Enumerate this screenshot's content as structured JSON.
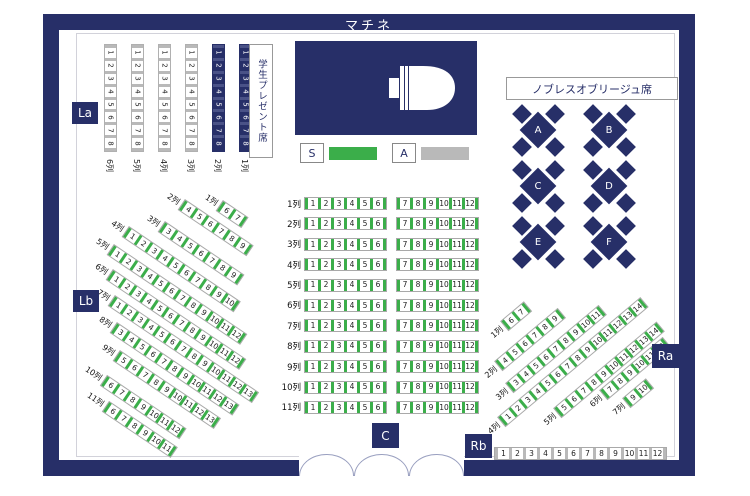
{
  "title": "マチネ",
  "legend": {
    "s_label": "S",
    "a_label": "A",
    "s_color": "#3bae4a",
    "a_color": "#b9b9b9"
  },
  "labels": {
    "la": "La",
    "lb": "Lb",
    "ra": "Ra",
    "rb": "Rb",
    "c": "C"
  },
  "student_seats_label": "学生プレゼント席",
  "noblesse": {
    "label": "ノブレスオブリージュ席",
    "tables": [
      "A",
      "B",
      "C",
      "D",
      "E",
      "F"
    ]
  },
  "la_block": {
    "columns": [
      {
        "label": "6列",
        "type": "a",
        "seats": [
          1,
          2,
          3,
          4,
          5,
          6,
          7,
          8
        ]
      },
      {
        "label": "5列",
        "type": "a",
        "seats": [
          1,
          2,
          3,
          4,
          5,
          6,
          7,
          8
        ]
      },
      {
        "label": "4列",
        "type": "a",
        "seats": [
          1,
          2,
          3,
          4,
          5,
          6,
          7,
          8
        ]
      },
      {
        "label": "3列",
        "type": "a",
        "seats": [
          1,
          2,
          3,
          4,
          5,
          6,
          7,
          8
        ]
      },
      {
        "label": "2列",
        "type": "reserved",
        "seats": [
          1,
          2,
          3,
          4,
          5,
          6,
          7,
          8
        ]
      },
      {
        "label": "1列",
        "type": "reserved",
        "seats": [
          1,
          2,
          3,
          4,
          5,
          6,
          7,
          8
        ]
      }
    ]
  },
  "center_block": {
    "rows": [
      {
        "label": "1列",
        "left": [
          1,
          2,
          3,
          4,
          5,
          6
        ],
        "right": [
          7,
          8,
          9,
          10,
          11,
          12
        ]
      },
      {
        "label": "2列",
        "left": [
          1,
          2,
          3,
          4,
          5,
          6
        ],
        "right": [
          7,
          8,
          9,
          10,
          11,
          12
        ]
      },
      {
        "label": "3列",
        "left": [
          1,
          2,
          3,
          4,
          5,
          6
        ],
        "right": [
          7,
          8,
          9,
          10,
          11,
          12
        ]
      },
      {
        "label": "4列",
        "left": [
          1,
          2,
          3,
          4,
          5,
          6
        ],
        "right": [
          7,
          8,
          9,
          10,
          11,
          12
        ]
      },
      {
        "label": "5列",
        "left": [
          1,
          2,
          3,
          4,
          5,
          6
        ],
        "right": [
          7,
          8,
          9,
          10,
          11,
          12
        ]
      },
      {
        "label": "6列",
        "left": [
          1,
          2,
          3,
          4,
          5,
          6
        ],
        "right": [
          7,
          8,
          9,
          10,
          11,
          12
        ]
      },
      {
        "label": "7列",
        "left": [
          1,
          2,
          3,
          4,
          5,
          6
        ],
        "right": [
          7,
          8,
          9,
          10,
          11,
          12
        ]
      },
      {
        "label": "8列",
        "left": [
          1,
          2,
          3,
          4,
          5,
          6
        ],
        "right": [
          7,
          8,
          9,
          10,
          11,
          12
        ]
      },
      {
        "label": "9列",
        "left": [
          1,
          2,
          3,
          4,
          5,
          6
        ],
        "right": [
          7,
          8,
          9,
          10,
          11,
          12
        ]
      },
      {
        "label": "10列",
        "left": [
          1,
          2,
          3,
          4,
          5,
          6
        ],
        "right": [
          7,
          8,
          9,
          10,
          11,
          12
        ]
      },
      {
        "label": "11列",
        "left": [
          1,
          2,
          3,
          4,
          5,
          6
        ],
        "right": [
          7,
          8,
          9,
          10,
          11,
          12
        ]
      }
    ]
  },
  "lb_block": {
    "rows": [
      {
        "label": "1列",
        "seats": [
          6,
          7
        ]
      },
      {
        "label": "2列",
        "seats": [
          4,
          5,
          6,
          7,
          8,
          9
        ]
      },
      {
        "label": "3列",
        "seats": [
          3,
          4,
          5,
          6,
          7,
          8,
          9
        ]
      },
      {
        "label": "4列",
        "seats": [
          1,
          2,
          3,
          4,
          5,
          6,
          7,
          8,
          9,
          10
        ]
      },
      {
        "label": "5列",
        "seats": [
          1,
          2,
          3,
          4,
          5,
          6,
          7,
          8,
          9,
          10,
          11,
          12
        ]
      },
      {
        "label": "6列",
        "seats": [
          1,
          2,
          3,
          4,
          5,
          6,
          7,
          8,
          9,
          10,
          11,
          12
        ]
      },
      {
        "label": "7列",
        "seats": [
          1,
          2,
          3,
          4,
          5,
          6,
          7,
          8,
          9,
          10,
          11,
          12,
          13
        ]
      },
      {
        "label": "8列",
        "seats": [
          3,
          4,
          5,
          6,
          7,
          8,
          9,
          10,
          11,
          12,
          13
        ]
      },
      {
        "label": "9列",
        "seats": [
          5,
          6,
          7,
          8,
          9,
          10,
          11,
          12,
          13
        ]
      },
      {
        "label": "10列",
        "seats": [
          6,
          7,
          8,
          9,
          10,
          11,
          12
        ]
      },
      {
        "label": "11列",
        "seats": [
          6,
          7,
          8,
          9,
          10,
          11
        ]
      }
    ]
  },
  "ra_block": {
    "rows": [
      {
        "label": "1列",
        "seats": [
          6,
          7
        ]
      },
      {
        "label": "2列",
        "seats": [
          4,
          5,
          6,
          7,
          8,
          9
        ]
      },
      {
        "label": "3列",
        "seats": [
          3,
          4,
          5,
          6,
          7,
          8,
          9,
          10,
          11
        ]
      },
      {
        "label": "4列",
        "seats": [
          1,
          2,
          3,
          4,
          5,
          6,
          7,
          8,
          9,
          10,
          11,
          12,
          13,
          14
        ]
      },
      {
        "label": "5列",
        "seats": [
          5,
          6,
          7,
          8,
          9,
          10,
          11,
          12,
          13,
          14
        ]
      },
      {
        "label": "6列",
        "seats": [
          7,
          8,
          9,
          10,
          11,
          12
        ]
      },
      {
        "label": "7列",
        "seats": [
          9,
          10
        ]
      }
    ]
  },
  "rb_block": {
    "seats": [
      1,
      2,
      3,
      4,
      5,
      6,
      7,
      8,
      9,
      10,
      11,
      12
    ]
  },
  "seat_classes": {
    "S": "green",
    "A": "gray"
  }
}
